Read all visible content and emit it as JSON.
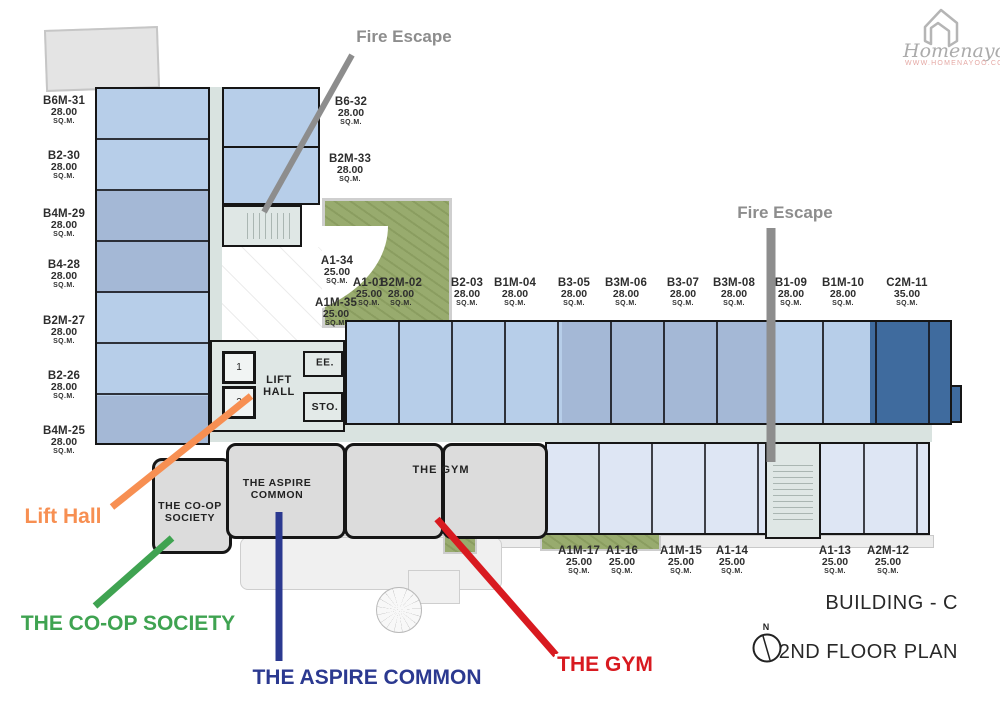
{
  "logo": {
    "name": "Homenayoo",
    "url": "WWW.HOMENAYOO.COM"
  },
  "titles": {
    "building": "BUILDING - C",
    "floor": "2ND FLOOR PLAN",
    "compass": "N"
  },
  "sqm_label": "SQ.M.",
  "colors": {
    "wall": "#161616",
    "unit_light": "#b7cee9",
    "unit_slate": "#a4b8d6",
    "unit_dark": "#3f6b9e",
    "unit_pale": "#dee6f4",
    "corridor": "#d9e3e0",
    "stair": "#dfe7e5",
    "amenity": "#dcdcdc",
    "green": "#93a766"
  },
  "rooms": {
    "lift_hall": "LIFT\nHALL",
    "lift_1": "1",
    "lift_2": "2",
    "ee": "EE.",
    "sto": "STO.",
    "aspire": "THE ASPIRE\nCOMMON",
    "gym": "THE GYM",
    "coop": "THE CO-OP\nSOCIETY"
  },
  "units": [
    {
      "id": "B6M-31",
      "area": "28.00",
      "cx": 64,
      "y": 95
    },
    {
      "id": "B2-30",
      "area": "28.00",
      "cx": 64,
      "y": 150
    },
    {
      "id": "B4M-29",
      "area": "28.00",
      "cx": 64,
      "y": 208
    },
    {
      "id": "B4-28",
      "area": "28.00",
      "cx": 64,
      "y": 259
    },
    {
      "id": "B2M-27",
      "area": "28.00",
      "cx": 64,
      "y": 315
    },
    {
      "id": "B2-26",
      "area": "28.00",
      "cx": 64,
      "y": 370
    },
    {
      "id": "B4M-25",
      "area": "28.00",
      "cx": 64,
      "y": 425
    },
    {
      "id": "B6-32",
      "area": "28.00",
      "cx": 351,
      "y": 96
    },
    {
      "id": "B2M-33",
      "area": "28.00",
      "cx": 350,
      "y": 153
    },
    {
      "id": "A1-34",
      "area": "25.00",
      "cx": 337,
      "y": 255
    },
    {
      "id": "A1-01",
      "area": "25.00",
      "cx": 369,
      "y": 277
    },
    {
      "id": "A1M-35",
      "area": "25.00",
      "cx": 336,
      "y": 297
    },
    {
      "id": "B2M-02",
      "area": "28.00",
      "cx": 401,
      "y": 277
    },
    {
      "id": "B2-03",
      "area": "28.00",
      "cx": 467,
      "y": 277
    },
    {
      "id": "B1M-04",
      "area": "28.00",
      "cx": 515,
      "y": 277
    },
    {
      "id": "B3-05",
      "area": "28.00",
      "cx": 574,
      "y": 277
    },
    {
      "id": "B3M-06",
      "area": "28.00",
      "cx": 626,
      "y": 277
    },
    {
      "id": "B3-07",
      "area": "28.00",
      "cx": 683,
      "y": 277
    },
    {
      "id": "B3M-08",
      "area": "28.00",
      "cx": 734,
      "y": 277
    },
    {
      "id": "B1-09",
      "area": "28.00",
      "cx": 791,
      "y": 277
    },
    {
      "id": "B1M-10",
      "area": "28.00",
      "cx": 843,
      "y": 277
    },
    {
      "id": "C2M-11",
      "area": "35.00",
      "cx": 907,
      "y": 277
    },
    {
      "id": "A1M-17",
      "area": "25.00",
      "cx": 579,
      "y": 545
    },
    {
      "id": "A1-16",
      "area": "25.00",
      "cx": 622,
      "y": 545
    },
    {
      "id": "A1M-15",
      "area": "25.00",
      "cx": 681,
      "y": 545
    },
    {
      "id": "A1-14",
      "area": "25.00",
      "cx": 732,
      "y": 545
    },
    {
      "id": "A1-13",
      "area": "25.00",
      "cx": 835,
      "y": 545
    },
    {
      "id": "A2M-12",
      "area": "25.00",
      "cx": 888,
      "y": 545
    }
  ],
  "annotations": [
    {
      "id": "fire-escape-top",
      "label": "Fire Escape",
      "color": "#8d8d8d",
      "x": 404,
      "y": 37,
      "size": 17,
      "line": [
        352,
        55,
        264,
        212
      ],
      "lw": 6
    },
    {
      "id": "fire-escape-right",
      "label": "Fire Escape",
      "color": "#8d8d8d",
      "x": 785,
      "y": 213,
      "size": 17,
      "line": [
        771,
        228,
        771,
        462
      ],
      "lw": 9
    },
    {
      "id": "lift-hall",
      "label": "Lift Hall",
      "color": "#f78f52",
      "x": 63,
      "y": 517,
      "size": 21,
      "line": [
        112,
        507,
        251,
        396
      ],
      "lw": 7
    },
    {
      "id": "coop-society",
      "label": "THE CO-OP SOCIETY",
      "color": "#3fa351",
      "x": 128,
      "y": 624,
      "size": 21,
      "line": [
        95,
        606,
        172,
        538
      ],
      "lw": 7
    },
    {
      "id": "aspire-common",
      "label": "THE ASPIRE COMMON",
      "color": "#2b3990",
      "x": 367,
      "y": 678,
      "size": 21,
      "line": [
        279,
        661,
        279,
        512
      ],
      "lw": 7
    },
    {
      "id": "the-gym",
      "label": "THE GYM",
      "color": "#d81a20",
      "x": 605,
      "y": 665,
      "size": 21,
      "line": [
        556,
        655,
        437,
        519
      ],
      "lw": 7
    }
  ]
}
